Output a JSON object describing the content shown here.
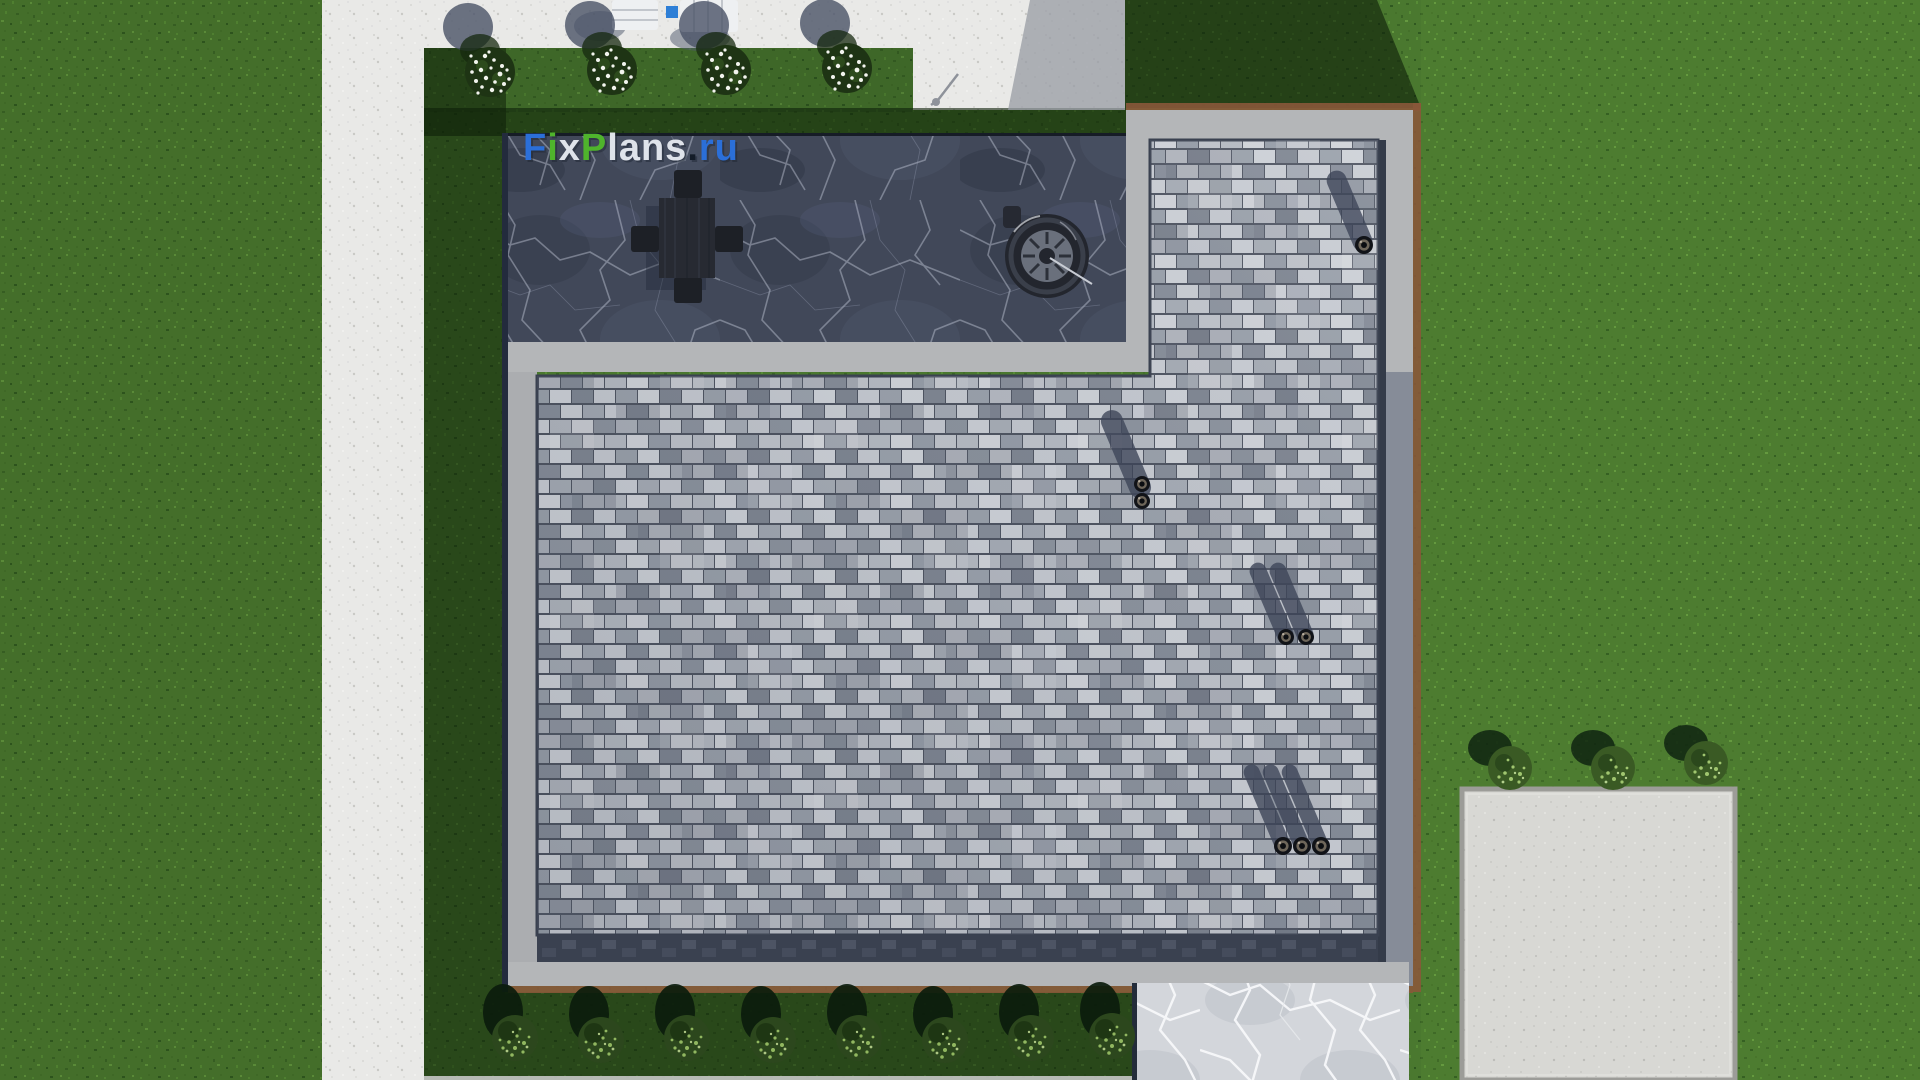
{
  "meta": {
    "description": "Top-down 3D render of a house roof and landscaped yard, FixPlans.ru watermark",
    "view": "aerial top view"
  },
  "watermark": {
    "text": "FixPlans.ru",
    "font_size": 38,
    "x": 523,
    "y": 160,
    "segments": [
      {
        "text": "F",
        "color": "#2b6fd8"
      },
      {
        "text": "i",
        "color": "#4fb42c"
      },
      {
        "text": "x",
        "color": "#dfe3ea"
      },
      {
        "text": "P",
        "color": "#4fb42c"
      },
      {
        "text": "lans",
        "color": "#dfe3ea"
      },
      {
        "text": ".",
        "color": "#141c28"
      },
      {
        "text": "ru",
        "color": "#2b6fd8"
      }
    ]
  },
  "palette": {
    "grass": "#4a782f",
    "grass_shadow": "#0e2009",
    "path_concrete": "#e9e9e7",
    "concrete_shadow": "#979ba3",
    "terrace_marble": "#414859",
    "marble_vein": "#d9dfee",
    "paver_light": "#ccd0d6",
    "paver_mid": "#a6acb5",
    "paver_dark": "#7f8692",
    "paver_seam": "#4e5461",
    "border_concrete": "#b4b6b8",
    "copper_edge": "#8a583a",
    "navy_edge": "#232b3d",
    "gutter_dark": "#3a4150",
    "walkway_marble": "#d3d6db",
    "driveway": "#d8d8d4",
    "chimney_shadow": "#3c4457",
    "pipe_ring": "#6e665a",
    "bush_dark": "#1e3414",
    "bush_leaf_light": "#a6cc74",
    "flower_white": "#f2f4ee",
    "furniture_charcoal": "#272a32",
    "lounger_white": "#eef0f2",
    "pool_blue": "#2e7fd6"
  },
  "scene": {
    "flower_bushes": [
      {
        "cx": 490,
        "cy": 72
      },
      {
        "cx": 612,
        "cy": 70
      },
      {
        "cx": 726,
        "cy": 70
      },
      {
        "cx": 847,
        "cy": 68
      }
    ],
    "hedge_bushes": [
      {
        "cx": 515,
        "cy": 1038
      },
      {
        "cx": 601,
        "cy": 1040
      },
      {
        "cx": 687,
        "cy": 1038
      },
      {
        "cx": 773,
        "cy": 1040
      },
      {
        "cx": 859,
        "cy": 1038
      },
      {
        "cx": 945,
        "cy": 1040
      },
      {
        "cx": 1031,
        "cy": 1038
      },
      {
        "cx": 1112,
        "cy": 1036
      }
    ],
    "driveway_bushes": [
      {
        "cx": 1510,
        "cy": 768
      },
      {
        "cx": 1613,
        "cy": 768
      },
      {
        "cx": 1706,
        "cy": 763
      }
    ],
    "chimneys": [
      {
        "name": "chimney-top-right",
        "pipes": [
          {
            "cx": 1364,
            "cy": 245,
            "r": 9
          }
        ],
        "shadows": [
          {
            "cx": 1364,
            "cy": 245,
            "w": 20,
            "len": 80
          }
        ]
      },
      {
        "name": "chimney-middle",
        "pipes": [
          {
            "cx": 1142,
            "cy": 484,
            "r": 8
          },
          {
            "cx": 1142,
            "cy": 501,
            "r": 8
          }
        ],
        "shadows": [
          {
            "cx": 1142,
            "cy": 492,
            "w": 22,
            "len": 88
          }
        ]
      },
      {
        "name": "chimney-right",
        "pipes": [
          {
            "cx": 1286,
            "cy": 637,
            "r": 8
          },
          {
            "cx": 1306,
            "cy": 637,
            "r": 8
          }
        ],
        "shadows": [
          {
            "cx": 1286,
            "cy": 637,
            "w": 17,
            "len": 80
          },
          {
            "cx": 1306,
            "cy": 637,
            "w": 17,
            "len": 80
          }
        ]
      },
      {
        "name": "chimney-bottom",
        "pipes": [
          {
            "cx": 1283,
            "cy": 846,
            "r": 9
          },
          {
            "cx": 1302,
            "cy": 846,
            "r": 9
          },
          {
            "cx": 1321,
            "cy": 846,
            "r": 9
          }
        ],
        "shadows": [
          {
            "cx": 1283,
            "cy": 846,
            "w": 16,
            "len": 88
          },
          {
            "cx": 1302,
            "cy": 846,
            "w": 16,
            "len": 88
          },
          {
            "cx": 1321,
            "cy": 846,
            "w": 16,
            "len": 88
          }
        ]
      }
    ],
    "furniture": {
      "dining_table": {
        "cx": 687,
        "cy": 237
      },
      "fire_pit_grill": {
        "cx": 1047,
        "cy": 256,
        "radius": 42
      },
      "loungers": [
        {
          "x": 612,
          "y": 0,
          "w": 46,
          "h": 30
        },
        {
          "x": 680,
          "y": 0,
          "w": 58,
          "h": 32
        }
      ],
      "pool_blue_marker": {
        "x": 666,
        "y": 6,
        "w": 12,
        "h": 12
      }
    },
    "shadow_rotation_deg": -23
  }
}
